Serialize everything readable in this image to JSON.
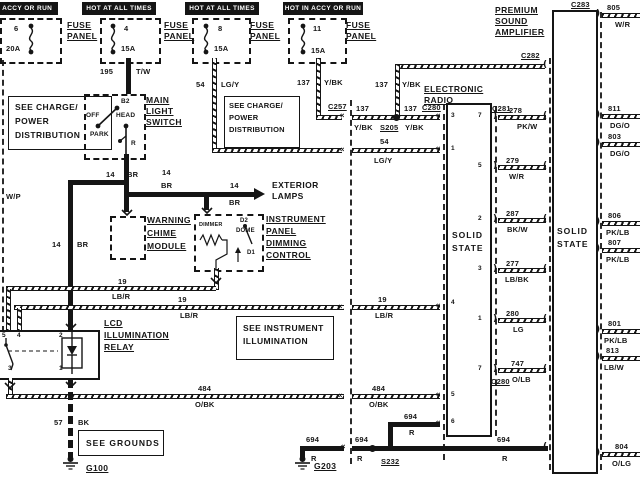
{
  "colors": {
    "ink": "#151515",
    "paper": "#ffffff"
  },
  "headers": [
    "HOT IN ACCY OR RUN",
    "HOT AT ALL TIMES",
    "HOT AT ALL TIMES",
    "HOT IN ACCY OR RUN"
  ],
  "fuse_label": {
    "line1": "FUSE",
    "line2": "PANEL"
  },
  "fuses": [
    {
      "number": "6",
      "rating": "20A"
    },
    {
      "number": "4",
      "rating": "15A"
    },
    {
      "number": "8",
      "rating": "15A"
    },
    {
      "number": "11",
      "rating": "15A"
    }
  ],
  "notes": {
    "see_charge": {
      "line1": "SEE CHARGE/",
      "line2": "POWER",
      "line3": "DISTRIBUTION"
    },
    "see_instrument": {
      "line1": "SEE INSTRUMENT",
      "line2": "ILLUMINATION"
    },
    "see_grounds": "SEE GROUNDS"
  },
  "components": {
    "main_light_switch": {
      "line1": "MAIN",
      "line2": "LIGHT",
      "line3": "SWITCH",
      "b2": "B2",
      "off": "OFF",
      "head": "HEAD",
      "park": "PARK",
      "r": "R"
    },
    "warning_chime": {
      "line1": "WARNING",
      "line2": "CHIME",
      "line3": "MODULE"
    },
    "dimming_control": {
      "line1": "INSTRUMENT",
      "line2": "PANEL",
      "line3": "DIMMING",
      "line4": "CONTROL",
      "dimmer": "DIMMER",
      "d2": "D2",
      "dome": "DOME",
      "d1": "D1"
    },
    "lcd_relay": {
      "line1": "LCD",
      "line2": "ILLUMINATION",
      "line3": "RELAY",
      "pin5": "5",
      "pin4": "4",
      "pin2": "2",
      "pin3": "3",
      "pin1": "1"
    },
    "radio": {
      "line1": "ELECTRONIC",
      "line2": "RADIO",
      "solid": "SOLID",
      "state": "STATE",
      "pins_left": [
        "3",
        "1",
        "4",
        "5",
        "6"
      ],
      "pins_right": [
        "7",
        "5",
        "2",
        "3",
        "1",
        "7"
      ]
    },
    "amplifier": {
      "line1": "PREMIUM",
      "line2": "SOUND",
      "line3": "AMPLIFIER",
      "solid": "SOLID",
      "state": "STATE"
    },
    "exterior_lamps": {
      "line1": "EXTERIOR",
      "line2": "LAMPS"
    }
  },
  "connectors": {
    "c257": "C257",
    "c280": "C280",
    "c281": "C281",
    "c282": "C282",
    "c283": "C283",
    "s205": "S205",
    "s232": "S232",
    "g100": "G100",
    "g203": "G203"
  },
  "wires": {
    "w195": {
      "number": "195",
      "color": "T/W"
    },
    "w54": {
      "number": "54",
      "color": "LG/Y"
    },
    "w137": {
      "number": "137",
      "color": "Y/BK"
    },
    "w14": {
      "number": "14",
      "color": "BR"
    },
    "w19": {
      "number": "19",
      "color": "LB/R"
    },
    "w484": {
      "number": "484",
      "color": "O/BK"
    },
    "w694": {
      "number": "694",
      "color": "R"
    },
    "w57": {
      "number": "57",
      "color": "BK"
    },
    "wp": {
      "color": "W/P"
    },
    "w278": {
      "number": "278",
      "color": "PK/W"
    },
    "w279": {
      "number": "279",
      "color": "W/R"
    },
    "w287": {
      "number": "287",
      "color": "BK/W"
    },
    "w277": {
      "number": "277",
      "color": "LB/BK"
    },
    "w280": {
      "number": "280",
      "color": "LG"
    },
    "w747": {
      "number": "747",
      "color": "O/LB"
    },
    "w805": {
      "number": "805",
      "color": "W/R"
    },
    "w811": {
      "number": "811",
      "color": "DG/O"
    },
    "w803": {
      "number": "803",
      "color": "DG/O"
    },
    "w806": {
      "number": "806",
      "color": "PK/LB"
    },
    "w807": {
      "number": "807",
      "color": "PK/LB"
    },
    "w801": {
      "number": "801",
      "color": "PK/LB"
    },
    "w813": {
      "number": "813",
      "color": "LB/W"
    },
    "w804": {
      "number": "804",
      "color": "O/LG"
    }
  }
}
